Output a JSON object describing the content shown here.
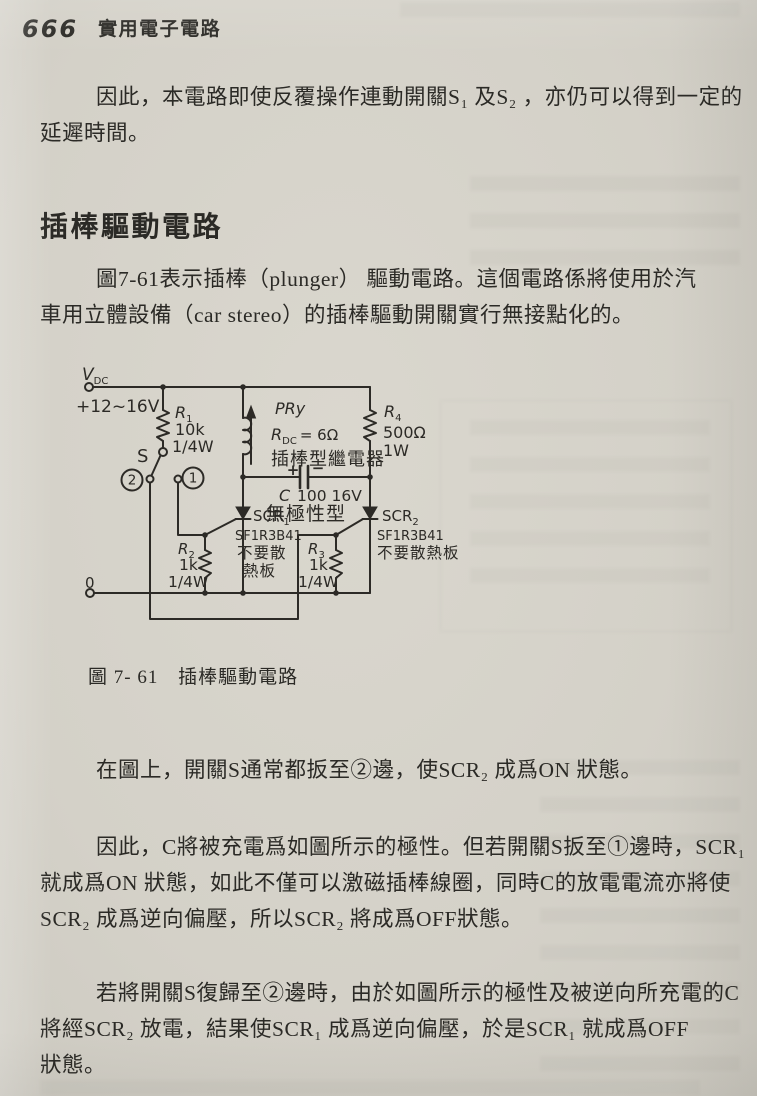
{
  "page": {
    "number": "666",
    "book_title": "實用電子電路"
  },
  "content": {
    "p1": {
      "lines": [
        "因此，本電路即使反覆操作連動開關S₁ 及S₂ ，亦仍可以得到一定的",
        "延遲時間。"
      ]
    },
    "section_heading": "插棒驅動電路",
    "p2": {
      "lines": [
        "圖7-61表示插棒（plunger） 驅動電路。這個電路係將使用於汽",
        "車用立體設備（car stereo）的插棒驅動開關實行無接點化的。"
      ]
    },
    "p3": {
      "lines": [
        "在圖上，開關S通常都扳至②邊，使SCR₂ 成爲ON 狀態。"
      ]
    },
    "p4": {
      "lines": [
        "因此，C將被充電爲如圖所示的極性。但若開關S扳至①邊時，SCR₁",
        "就成爲ON 狀態，如此不僅可以激磁插棒線圈，同時C的放電電流亦將使",
        "SCR₂ 成爲逆向偏壓，所以SCR₂ 將成爲OFF狀態。"
      ]
    },
    "p5": {
      "lines": [
        "若將開關S復歸至②邊時，由於如圖所示的極性及被逆向所充電的C",
        "將經SCR₂ 放電，結果使SCR₁ 成爲逆向偏壓，於是SCR₁ 就成爲OFF",
        "狀態。"
      ]
    },
    "figure": {
      "caption_label": "圖 7- 61",
      "caption_title": "插棒驅動電路",
      "circuit": {
        "vdc": {
          "sym": "V",
          "sub": "DC",
          "value": "+12~16V"
        },
        "r1": {
          "sym": "R",
          "sub": "1",
          "value": "10k",
          "power": "1/4W"
        },
        "switch": {
          "label": "S",
          "pos2": "2",
          "pos1": "1"
        },
        "relay": {
          "name": "PRy",
          "rdc_sym": "R",
          "rdc_sub": "DC",
          "rdc_val": "= 6Ω",
          "type": "插棒型繼電器"
        },
        "cap": {
          "plus": "+",
          "minus": "−",
          "sym": "C",
          "value": "100 16V",
          "type": "無極性型"
        },
        "scr1": {
          "name": "SCR",
          "sub": "1",
          "part": "SF1R3B41",
          "note_line1": "不要散",
          "note_line2": "熱板"
        },
        "scr2": {
          "name": "SCR",
          "sub": "2",
          "part": "SF1R3B41",
          "note": "不要散熱板"
        },
        "r2": {
          "sym": "R",
          "sub": "2",
          "value": "1k",
          "power": "1/4W"
        },
        "r3": {
          "sym": "R",
          "sub": "3",
          "value": "1k",
          "power": "1/4W"
        },
        "r4": {
          "sym": "R",
          "sub": "4",
          "value": "500Ω",
          "power": "1W"
        },
        "gnd": "0"
      }
    }
  }
}
